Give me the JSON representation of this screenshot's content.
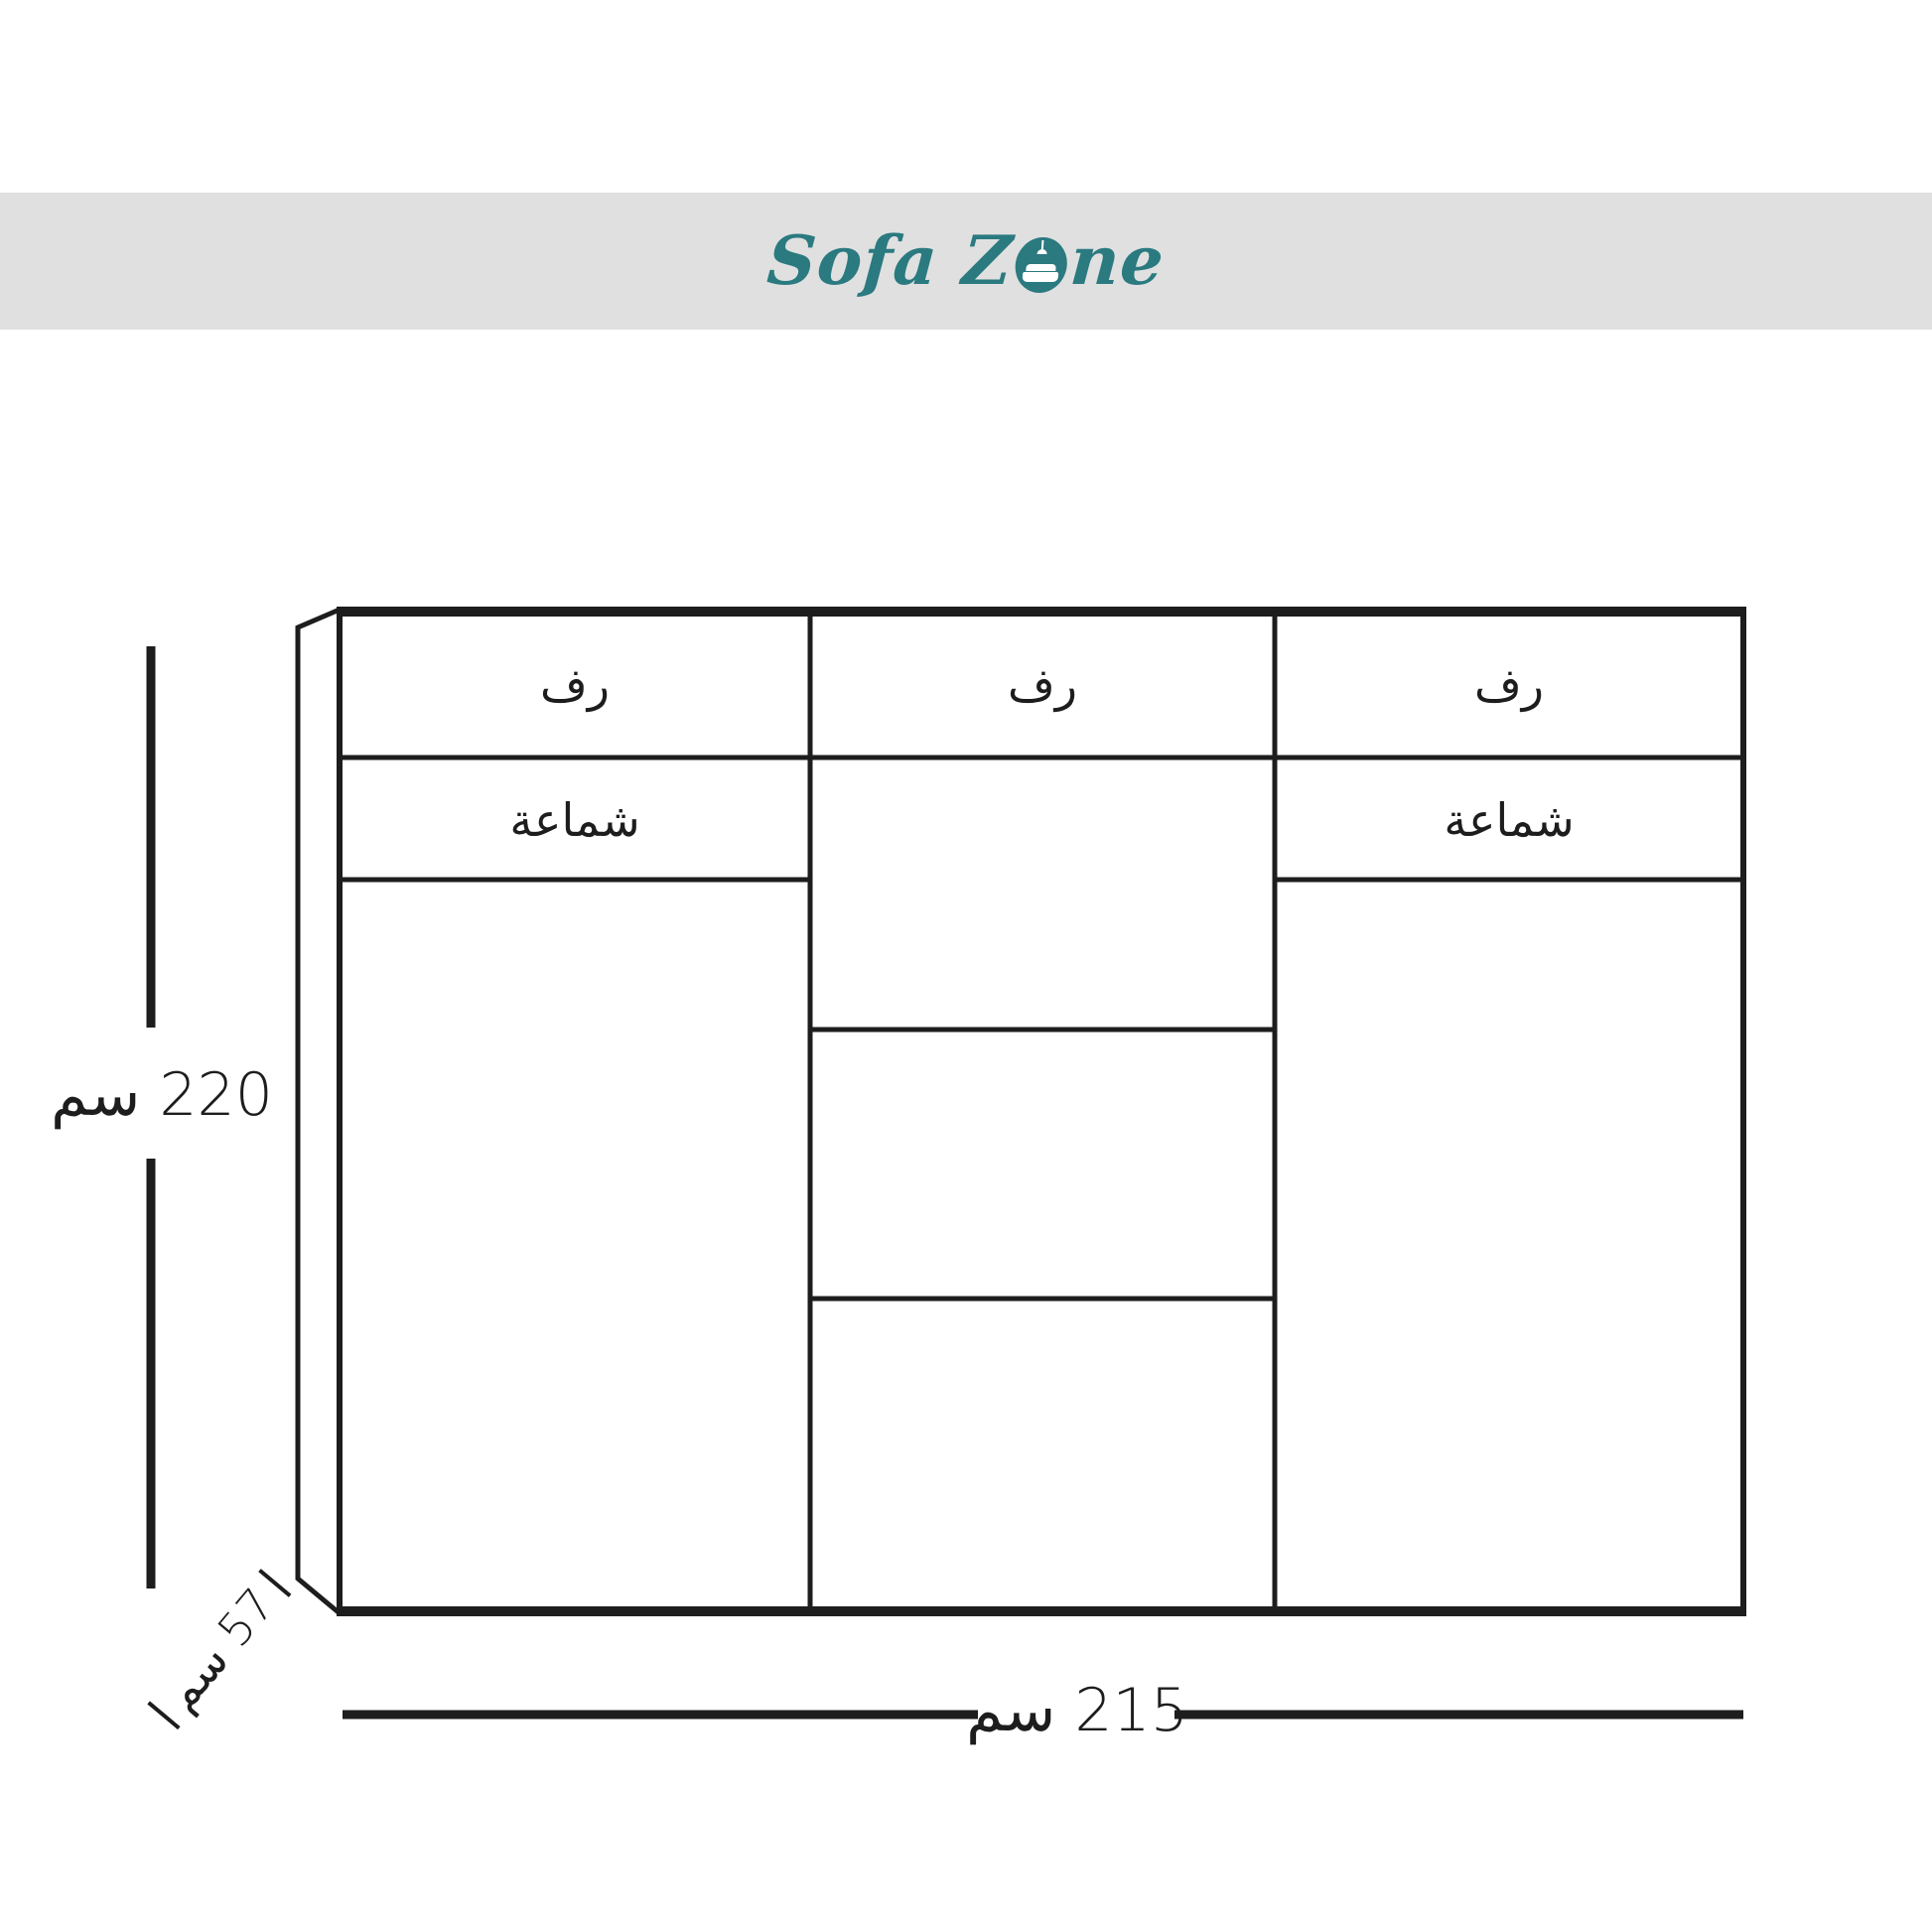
{
  "header": {
    "brand_part1": "Sofa Z",
    "brand_part2": "ne",
    "band_color": "#e0e0e0",
    "brand_color": "#2a7a80"
  },
  "wardrobe": {
    "line_color": "#1d1d1d",
    "columns": [
      {
        "shelf_label": "رف",
        "hanger_label": "شماعة"
      },
      {
        "shelf_label": "رف"
      },
      {
        "shelf_label": "رف",
        "hanger_label": "شماعة"
      }
    ]
  },
  "dimensions": {
    "height_label": "220 سم",
    "depth_label": "57 سم",
    "width_label": "215 سم"
  }
}
